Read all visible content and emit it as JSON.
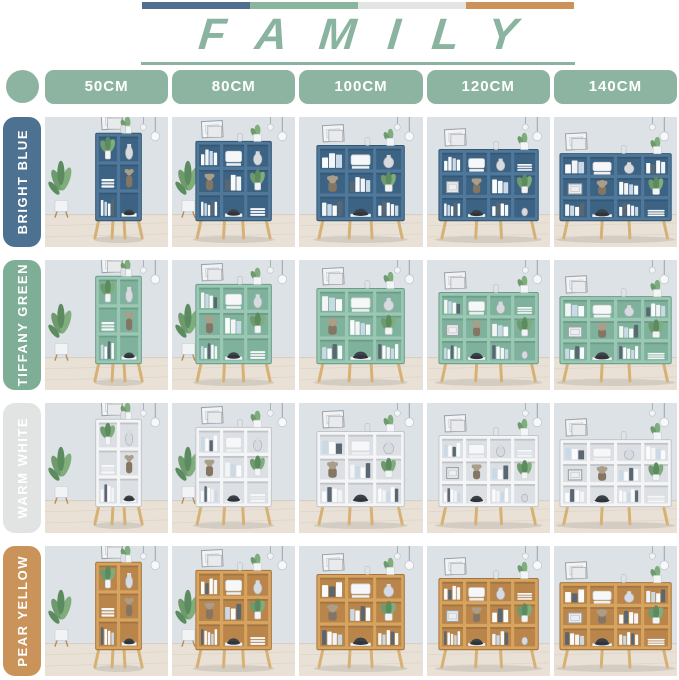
{
  "title": "FAMILY",
  "palette": {
    "accent_green": "#8cb4a1",
    "title_green": "#8ab3a0",
    "bar_segments": [
      "#4e6f8e",
      "#8ab59f",
      "#e3e5e3",
      "#cd9257"
    ]
  },
  "columns": [
    {
      "label": "50CM"
    },
    {
      "label": "80CM"
    },
    {
      "label": "100CM"
    },
    {
      "label": "120CM"
    },
    {
      "label": "140CM"
    }
  ],
  "rows": [
    {
      "label": "BRIGHT BLUE",
      "badge_color": "#4c7191",
      "shelf_color": "#4f789b",
      "shelf_inner": "#3d6384",
      "shelf_edge": "#35566f"
    },
    {
      "label": "TIFFANY GREEN",
      "badge_color": "#7fae97",
      "shelf_color": "#9bc8b4",
      "shelf_inner": "#7fb29d",
      "shelf_edge": "#6a9c87"
    },
    {
      "label": "WARM WHITE",
      "badge_color": "#e2e4e3",
      "shelf_color": "#f4f5f7",
      "shelf_inner": "#dcdfe3",
      "shelf_edge": "#c2c6cb"
    },
    {
      "label": "PEAR YELLOW",
      "badge_color": "#c9935a",
      "shelf_color": "#d7a45f",
      "shelf_inner": "#b9854a",
      "shelf_edge": "#a37440"
    }
  ],
  "scene": {
    "wall": "#dde2e7",
    "floor": "#e9e1d5",
    "floor_line": "#d6ccbe",
    "legs": "#d6b173",
    "book_white": "#fafbfc",
    "book_blue": "#c9d9e6",
    "book_dark": "#5b6770",
    "plant_green_1": "#6f9a6e",
    "plant_green_2": "#7fae7c",
    "plant_green_3": "#5d8b60",
    "shadow": "rgba(60,60,60,0.12)"
  }
}
